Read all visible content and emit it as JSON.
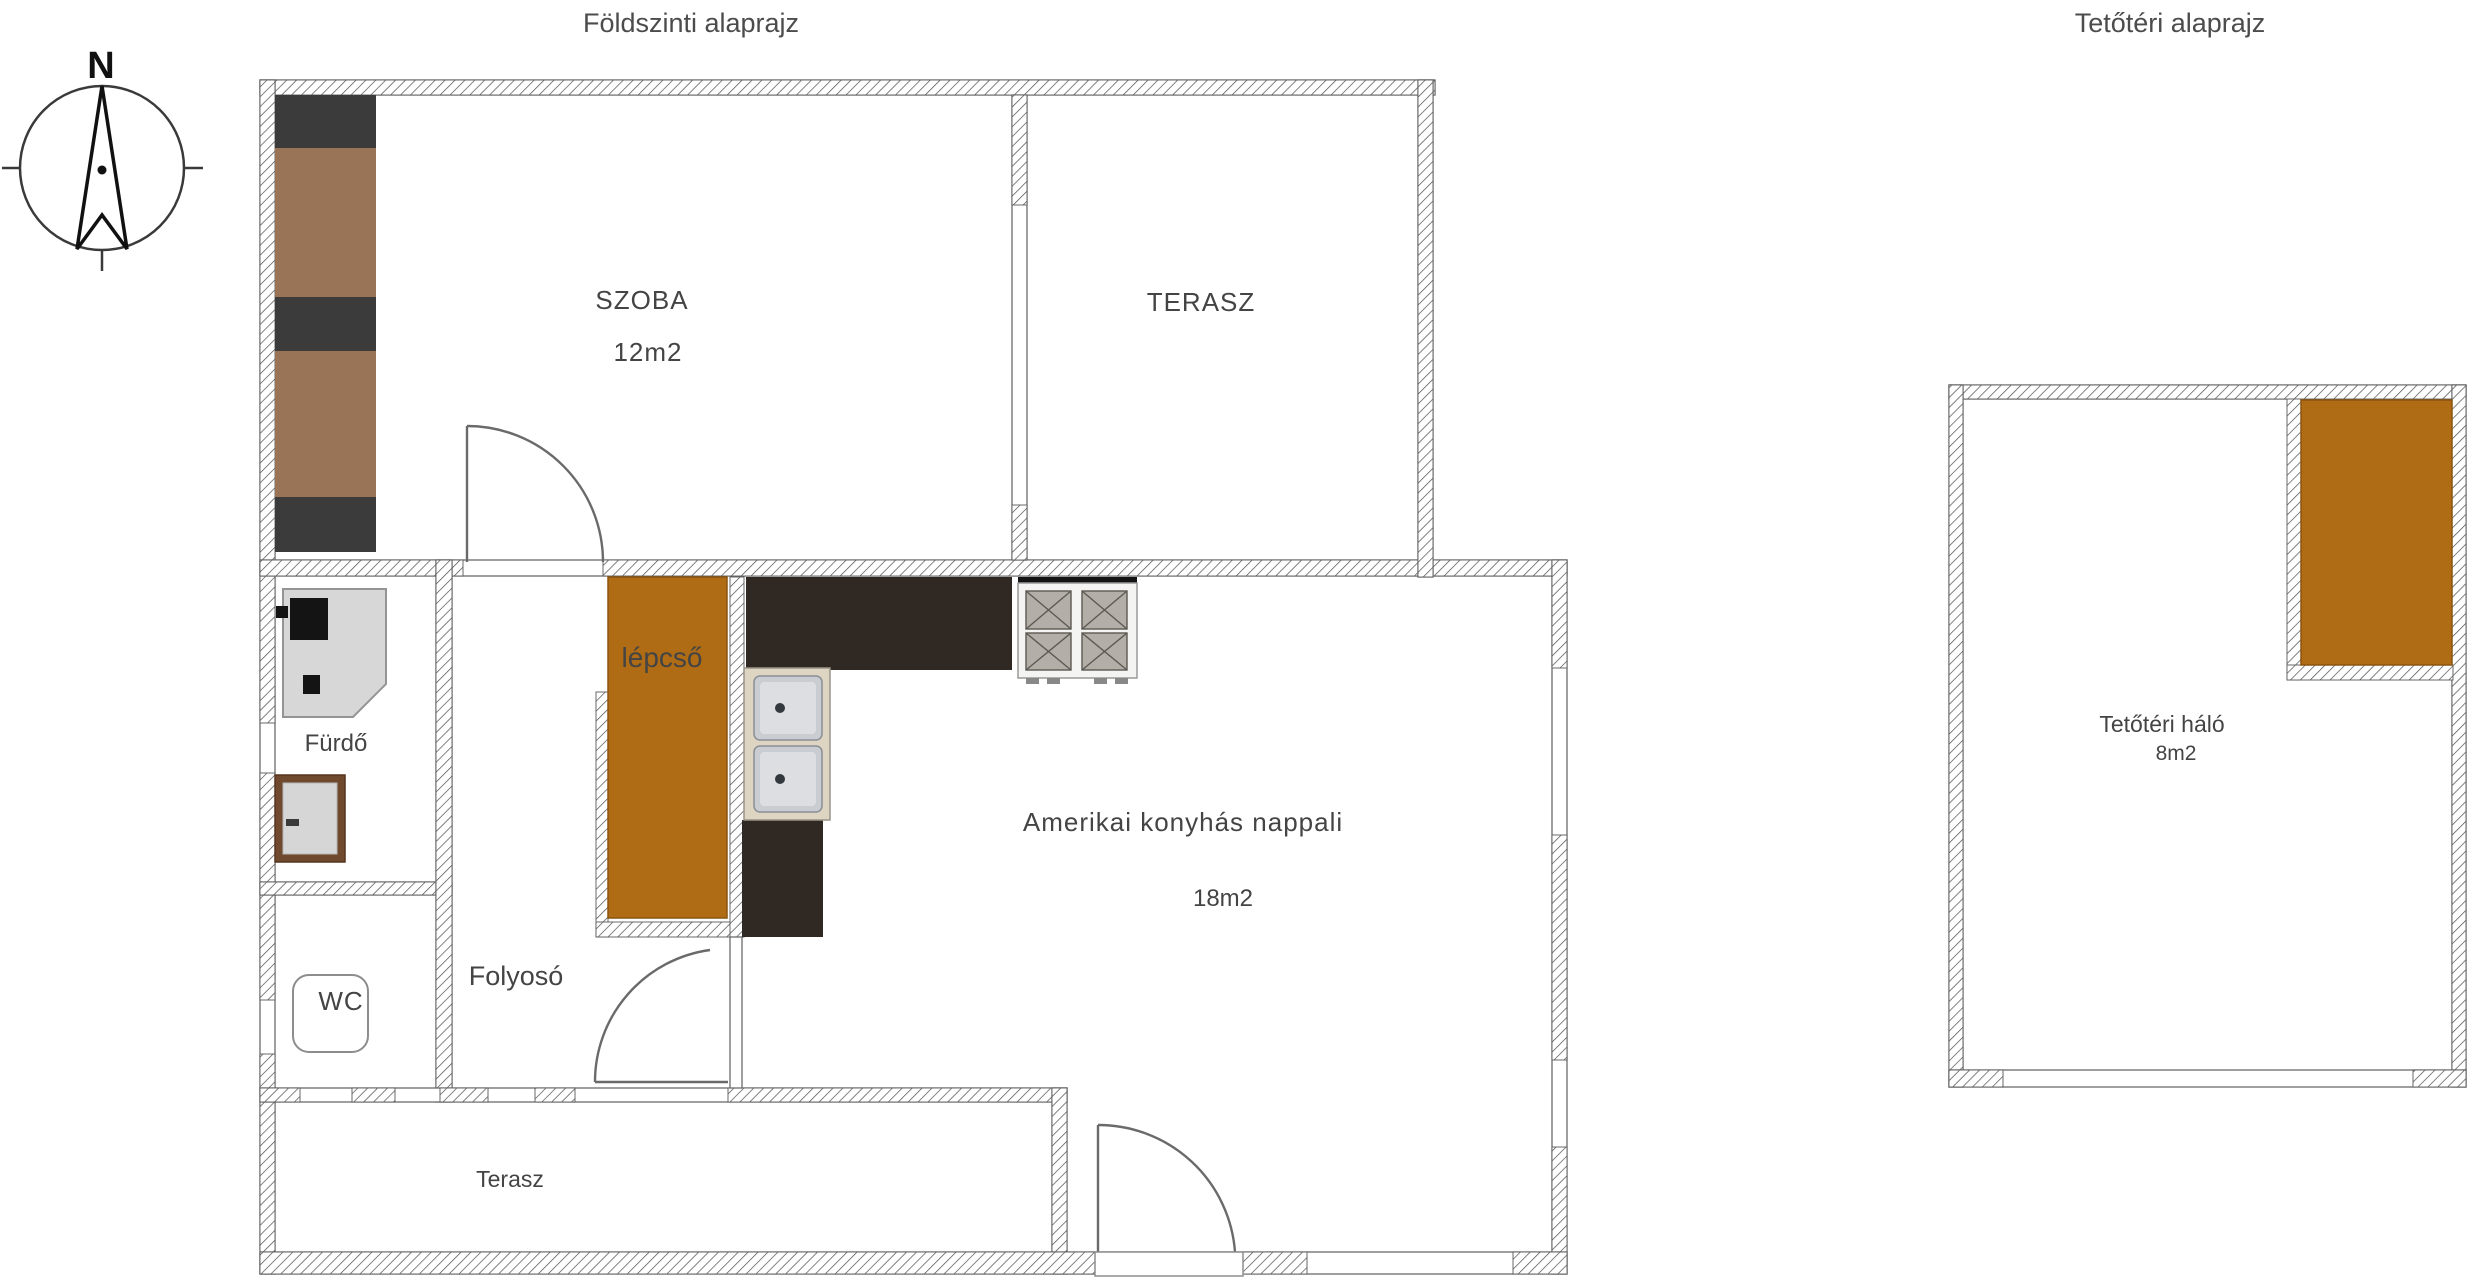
{
  "titles": {
    "ground_floor": "Földszinti alaprajz",
    "attic": "Tetőtéri alaprajz"
  },
  "compass": {
    "north_label": "N"
  },
  "colors": {
    "stairs_orange": "#b06c15",
    "attic_stairs_orange": "#b06c15",
    "wardrobe_wood": "#9a7456",
    "wardrobe_dark": "#3b3b3b",
    "counter_dark": "#2f2823",
    "stairs_label_brown": "#3a2306"
  },
  "ground_floor": {
    "rooms": {
      "szoba": {
        "label": "SZOBA",
        "area": "12m2"
      },
      "terasz_top": {
        "label": "TERASZ"
      },
      "stairs": {
        "label": "lépcső"
      },
      "bathroom": {
        "label": "Fürdő"
      },
      "wc": {
        "label": "WC"
      },
      "hallway": {
        "label": "Folyosó"
      },
      "living": {
        "label": "Amerikai konyhás nappali",
        "area": "18m2"
      },
      "terrace_bottom": {
        "label": "Terasz"
      }
    }
  },
  "attic": {
    "rooms": {
      "bedroom": {
        "label": "Tetőtéri háló",
        "area": "8m2"
      }
    }
  }
}
